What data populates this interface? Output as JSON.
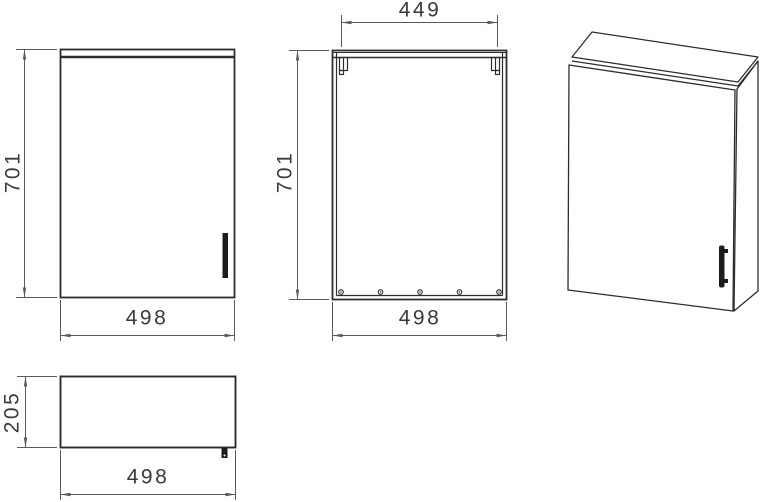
{
  "drawing": {
    "kind": "wall-cabinet technical drawing, 3 orthographic views + isometric",
    "views": {
      "front": {
        "height": "701",
        "width": "498"
      },
      "back": {
        "hanger_span": "449",
        "height": "701",
        "width": "498"
      },
      "top": {
        "depth": "205",
        "width": "498"
      }
    },
    "colors": {
      "background": "#ffffff",
      "object_line": "#2d2d2d",
      "dimension_line": "#5a5a5a",
      "handle_fill": "#1c1c1c",
      "label_text": "#3a3a3a"
    }
  }
}
